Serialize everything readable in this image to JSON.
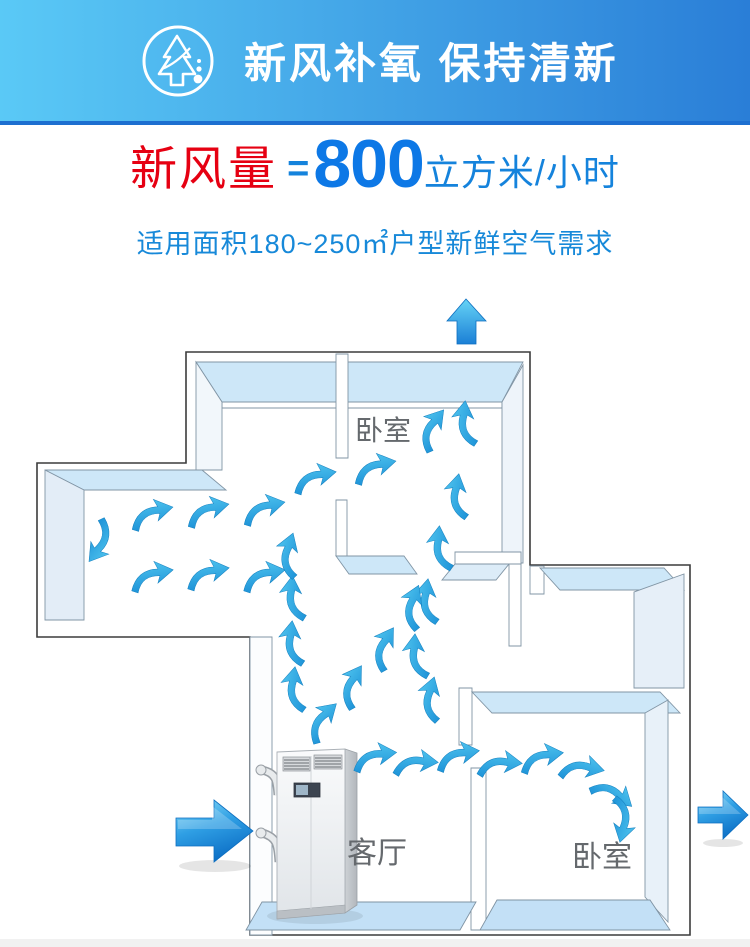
{
  "header": {
    "title": "新风补氧 保持清新",
    "icon": "fresh-air-tree-icon",
    "bg_left": "#5ac9f6",
    "bg_right": "#2a7ed7",
    "border_bottom": "#1d6fd0"
  },
  "headline": {
    "label": "新风量",
    "equals": "=",
    "value": "800",
    "unit": "立方米/小时",
    "label_color": "#e60012",
    "value_color": "#0d78e6",
    "unit_color": "#1583dc"
  },
  "subtitle": {
    "text": "适用面积180~250㎡户型新鲜空气需求",
    "color": "#1789d9"
  },
  "floorplan": {
    "rooms": [
      {
        "id": "bedroom-top",
        "label": "卧室"
      },
      {
        "id": "living-room",
        "label": "客厅"
      },
      {
        "id": "bedroom-right",
        "label": "卧室"
      }
    ],
    "unit_name": "fresh-air-ventilation-unit",
    "big_arrows": [
      {
        "name": "intake-arrow-left"
      },
      {
        "name": "exhaust-arrow-right"
      },
      {
        "name": "exit-arrow-top"
      }
    ],
    "colors": {
      "wall_top": "#cde7f8",
      "wall_face": "#e8f1f9",
      "floor": "#c3e0f6",
      "outline": "#3c3c3c",
      "airflow": "#2aa7e0",
      "label": "#65696d"
    },
    "airflow_arrows": [
      [
        432,
        430,
        -50
      ],
      [
        466,
        424,
        -82
      ],
      [
        314,
        479,
        -8
      ],
      [
        374,
        469,
        -10
      ],
      [
        458,
        497,
        -78
      ],
      [
        441,
        549,
        -84
      ],
      [
        428,
        602,
        -80
      ],
      [
        417,
        657,
        -85
      ],
      [
        431,
        700,
        -72
      ],
      [
        100,
        541,
        128
      ],
      [
        151,
        515,
        -10
      ],
      [
        207,
        512,
        -10
      ],
      [
        263,
        510,
        -10
      ],
      [
        151,
        577,
        -8
      ],
      [
        207,
        575,
        -8
      ],
      [
        263,
        577,
        -8
      ],
      [
        295,
        690,
        -80
      ],
      [
        293,
        644,
        -82
      ],
      [
        294,
        599,
        -84
      ],
      [
        289,
        556,
        -70
      ],
      [
        322,
        722,
        -42
      ],
      [
        352,
        687,
        -56
      ],
      [
        384,
        649,
        -56
      ],
      [
        413,
        608,
        -66
      ],
      [
        374,
        758,
        -4
      ],
      [
        415,
        764,
        6
      ],
      [
        457,
        757,
        -6
      ],
      [
        499,
        765,
        6
      ],
      [
        541,
        759,
        -6
      ],
      [
        581,
        769,
        14
      ],
      [
        612,
        794,
        42
      ],
      [
        622,
        819,
        105
      ]
    ]
  }
}
